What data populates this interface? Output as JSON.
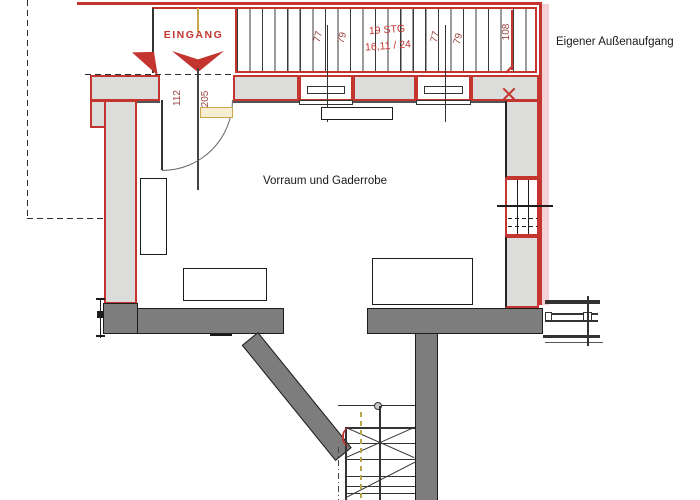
{
  "plan": {
    "labels": {
      "entrance": "EINGANG",
      "room": "Vorraum und Gaderrobe",
      "exterior_note": "Eigener Außenaufgang",
      "stair_count": "19 STG",
      "stair_ratio": "16,11 / 24"
    },
    "dimensions": {
      "tread_width_1": "77",
      "tread_width_2": "79",
      "tread_width_3": "77",
      "tread_width_4": "79",
      "stair_width": "108",
      "door_width": "112",
      "door_height": "205"
    },
    "colors": {
      "plan_red": "#c5352f",
      "dimension_text": "#9b453f",
      "wall_light": "#dcdcda",
      "wall_dark": "#7d7d7d",
      "outline_black": "#1c1c1c",
      "tint_pink": "#f1c5c9",
      "axis_tan": "#c9a84c",
      "stair_dash_olive": "#b5a84a"
    }
  }
}
